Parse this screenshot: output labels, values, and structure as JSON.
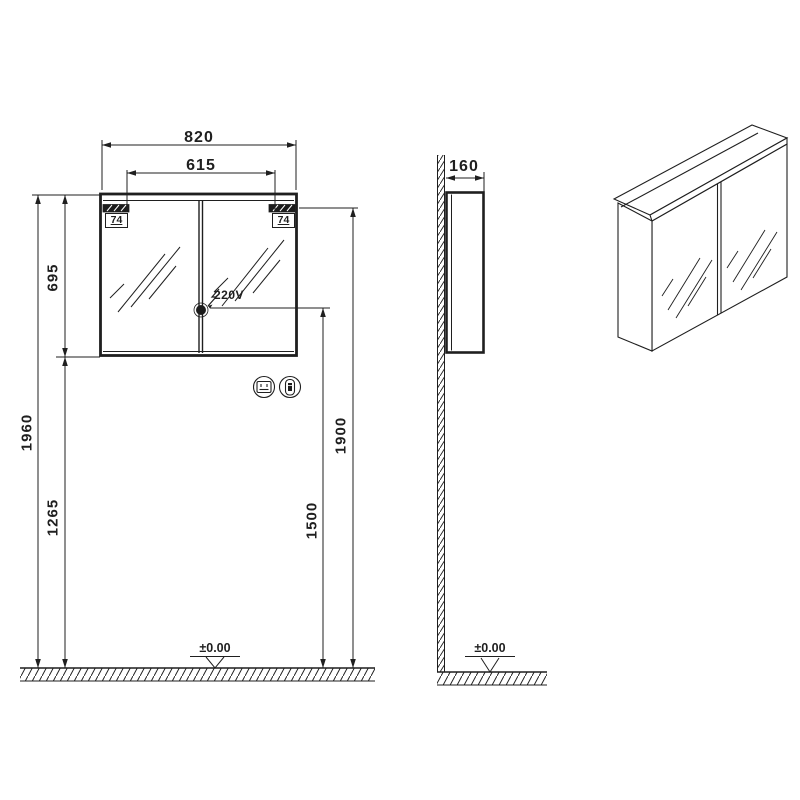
{
  "front_view": {
    "width_total": "820",
    "lights_spacing": "615",
    "light_width_left": "74",
    "light_width_right": "74",
    "cabinet_height": "695",
    "total_height": "1960",
    "cabinet_bottom_height": "1265",
    "mirror_top_height": "1900",
    "socket_height": "1500",
    "socket_voltage": "220V",
    "floor_level": "±0.00"
  },
  "side_view": {
    "depth": "160",
    "floor_level": "±0.00"
  },
  "icons": {
    "socket": "socket-icon",
    "switch": "switch-icon",
    "lightning": "lightning-icon",
    "level_marker": "level-marker-icon"
  },
  "colors": {
    "line": "#1f1f1f",
    "background": "#ffffff"
  }
}
